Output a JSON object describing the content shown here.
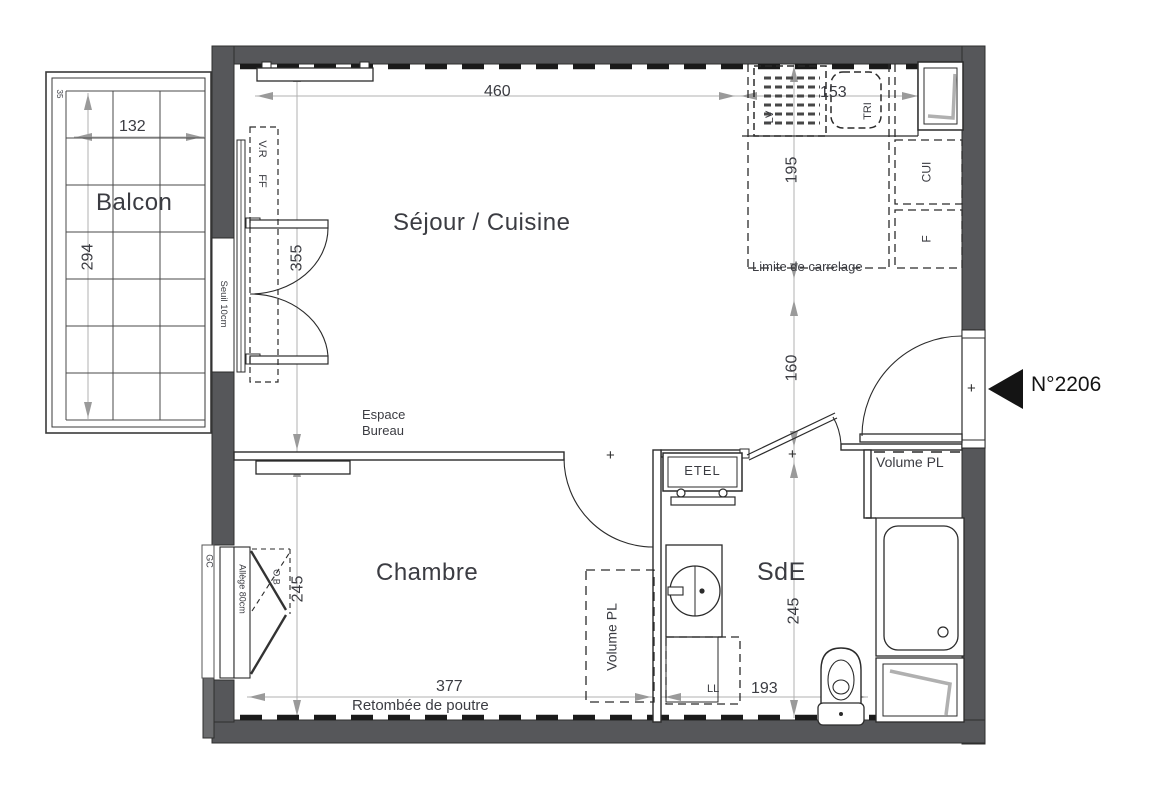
{
  "plan": {
    "unit": {
      "number": "N°2206"
    },
    "rooms": {
      "balcony": "Balcon",
      "living_kitchen": "Séjour / Cuisine",
      "bedroom": "Chambre",
      "shower_room": "SdE"
    },
    "annotations": {
      "threshold": "Seuil 10cm",
      "roller_shutter": "V.R",
      "window_ff": "FF",
      "dishwasher": "LV",
      "sorting_bin": "TRI",
      "kitchen_unit": "CUI",
      "fridge": "F",
      "tiling_limit": "Limite de carrelage",
      "desk_area_line1": "Espace",
      "desk_area_line2": "Bureau",
      "water_panel": "ETEL",
      "closet_entry": "Volume PL",
      "closet_bedroom": "Volume PL",
      "washing_machine": "LL",
      "beam_drop": "Retombée de poutre",
      "sill": "Allège 80cm",
      "gc": "GC",
      "ob": "O.B",
      "corner_mark": "35",
      "plus_mark": "+"
    },
    "dimensions_cm": {
      "living_width": "460",
      "kitchen_width": "153",
      "kitchen_depth": "195",
      "entry_depth": "160",
      "living_depth": "355",
      "balcony_width": "132",
      "balcony_depth": "294",
      "bedroom_depth": "245",
      "bedroom_width": "377",
      "shower_room_width": "193",
      "shower_room_depth": "245"
    },
    "colors": {
      "wall": "#56575a",
      "line": "#2b2b2b",
      "dim_line": "#b0b0b0",
      "text": "#3b3c42",
      "accent": "#141414"
    }
  }
}
